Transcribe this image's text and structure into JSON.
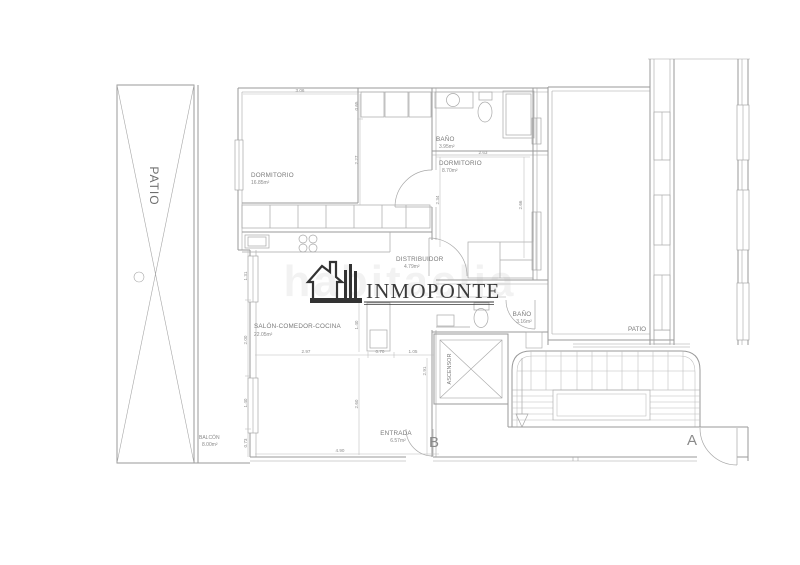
{
  "logo": {
    "brand": "INMOPONTE",
    "watermark": "habitaclia"
  },
  "rooms": {
    "patio_left": {
      "label": "PATIO"
    },
    "dormitorio1": {
      "label": "DORMITORIO",
      "area": "16.85m²"
    },
    "bano1": {
      "label": "BAÑO",
      "area": "3.95m²"
    },
    "dormitorio2": {
      "label": "DORMITORIO",
      "area": "8.70m²"
    },
    "distribuidor": {
      "label": "DISTRIBUIDOR",
      "area": "4.79m²"
    },
    "salon": {
      "label": "SALÓN-COMEDOR-COCINA",
      "area": "22.05m²"
    },
    "bano2": {
      "label": "BAÑO",
      "area": "3.16m²"
    },
    "entrada": {
      "label": "ENTRADA",
      "area": "6.57m²"
    },
    "balcon": {
      "label": "BALCÓN",
      "area": "8.00m²"
    },
    "ascensor": {
      "label": "ASCENSOR"
    },
    "patio_right": {
      "label": "PATIO"
    }
  },
  "markers": {
    "door_a": "A",
    "door_b": "B"
  },
  "dimensions": {
    "d306": "3.06",
    "d065": "0.65",
    "d227": "2.27",
    "d263": "2.63",
    "d234": "2.34",
    "d266": "2.66",
    "d131": "1.31",
    "d200": "2.00",
    "d140a": "1.40",
    "d073": "0.73",
    "d297": "2.97",
    "d070": "0.70",
    "d105": "1.05",
    "d291": "2.91",
    "d140b": "1.40",
    "d260": "2.60",
    "d490": "4.90"
  },
  "colors": {
    "wall_line": "#9a9a9a",
    "fixture_line": "#a8a8a8",
    "dimension_line": "#bcbcbc",
    "dimension_text": "#8c8c8c",
    "label_text": "#7a7a7a",
    "logo": "#3a3a3a"
  }
}
